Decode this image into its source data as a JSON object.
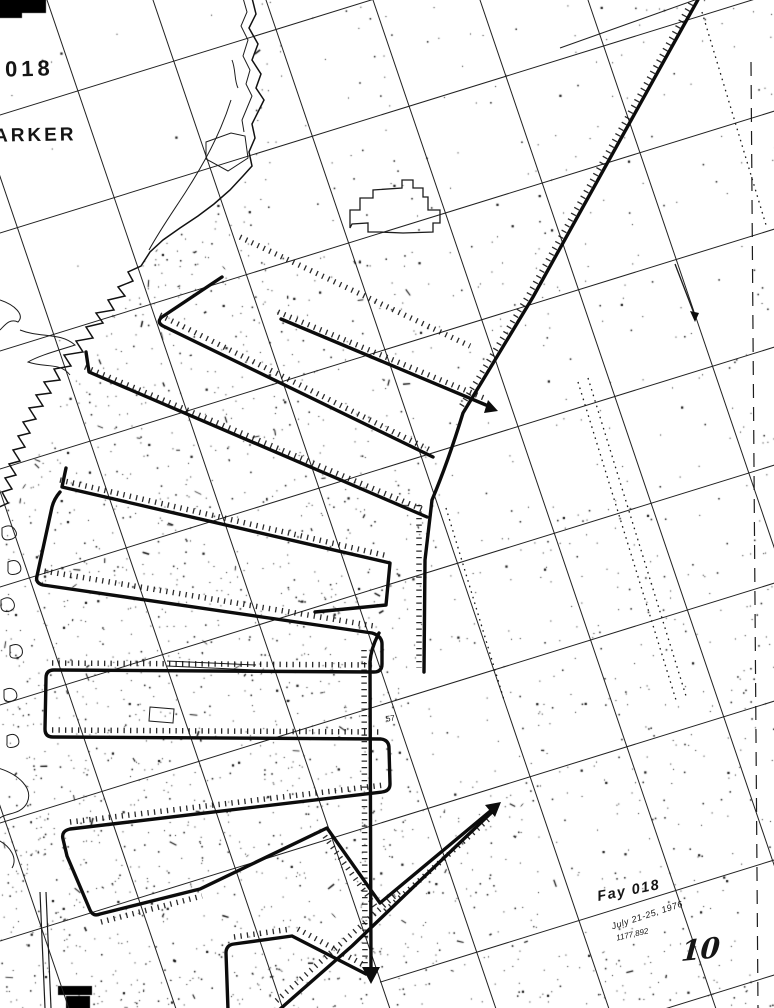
{
  "page": {
    "number": "10"
  },
  "corner": {
    "number": "018",
    "place_name": "ARKER"
  },
  "annotation": {
    "title": "Fay 018",
    "dates": "July 21-25, 1976",
    "reference": "1177,892"
  },
  "chart": {
    "sounding_label": "57"
  },
  "colors": {
    "paper": "#ffffff",
    "ink": "#161616"
  }
}
